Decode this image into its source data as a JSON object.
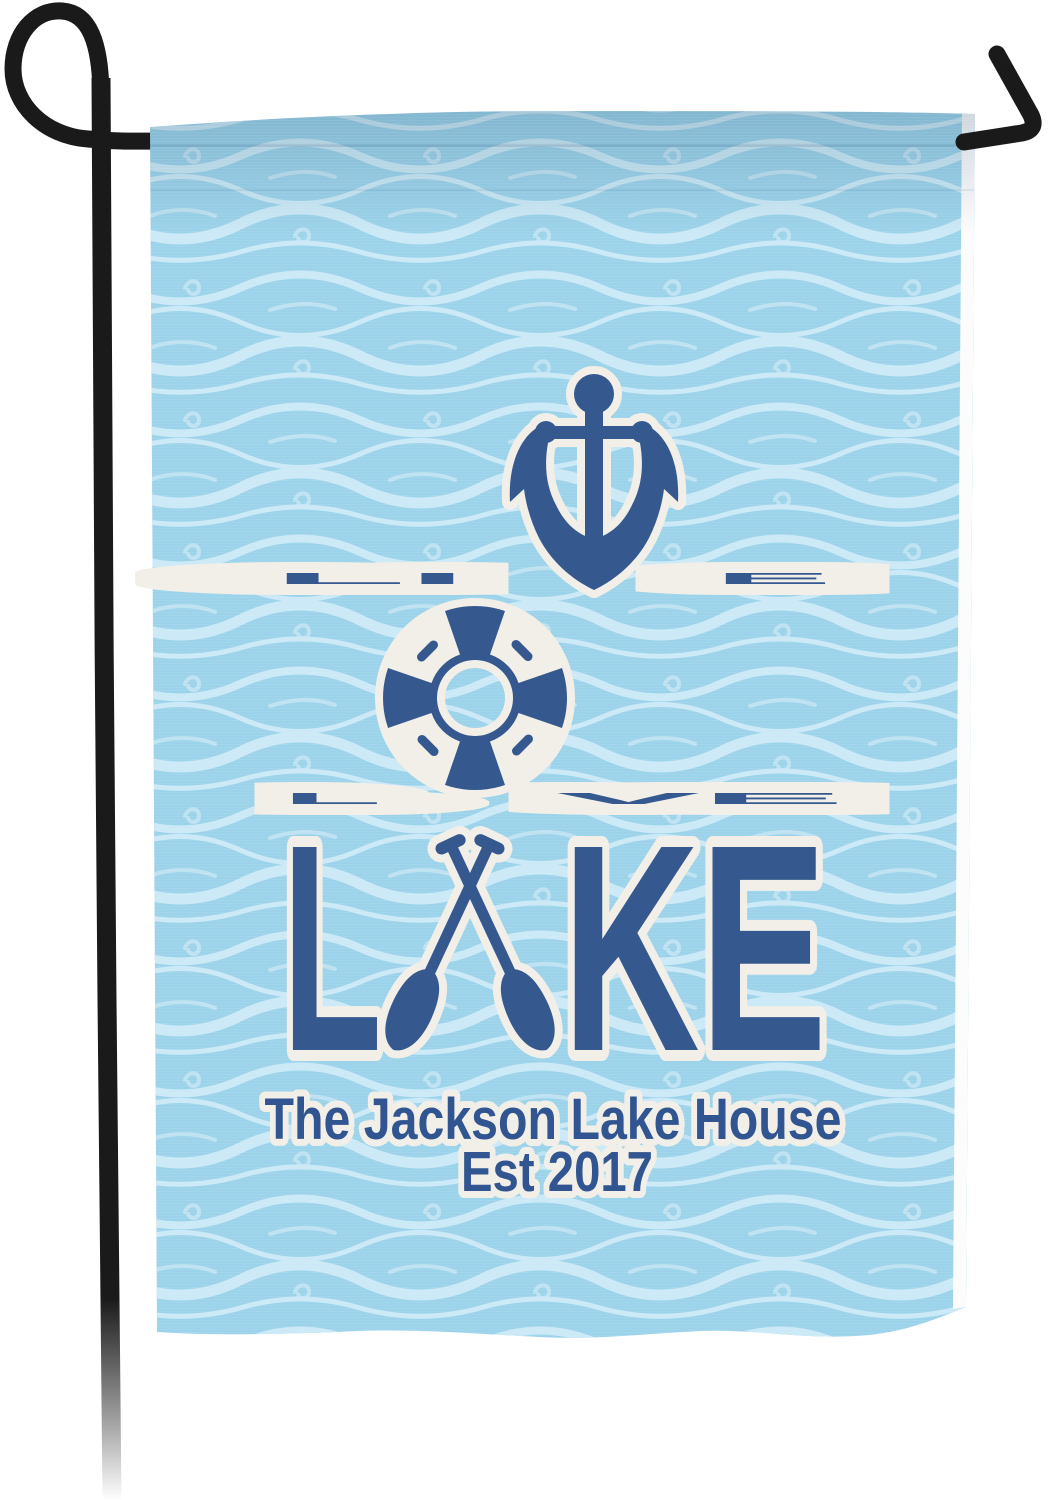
{
  "flag": {
    "words": [
      {
        "word": "LIVE",
        "left": "LI",
        "right": "E",
        "icon": "anchor-icon"
      },
      {
        "word": "LOVE",
        "left": "L",
        "right": "VE",
        "icon": "life-ring-icon"
      },
      {
        "word": "LAKE",
        "left": "L",
        "right": "KE",
        "icon": "crossed-oars-icon"
      }
    ],
    "caption_line1": "The Jackson Lake House",
    "caption_line2": "Est 2017",
    "colors": {
      "flag_base": "#9CD3EA",
      "wave_pattern_light": "#CBE9F6",
      "letter_blue": "#35598F",
      "letter_outline_white": "#F1EFE8",
      "edge_binding_white": "#FCFCFC",
      "stand_black": "#1A1A1A"
    }
  }
}
